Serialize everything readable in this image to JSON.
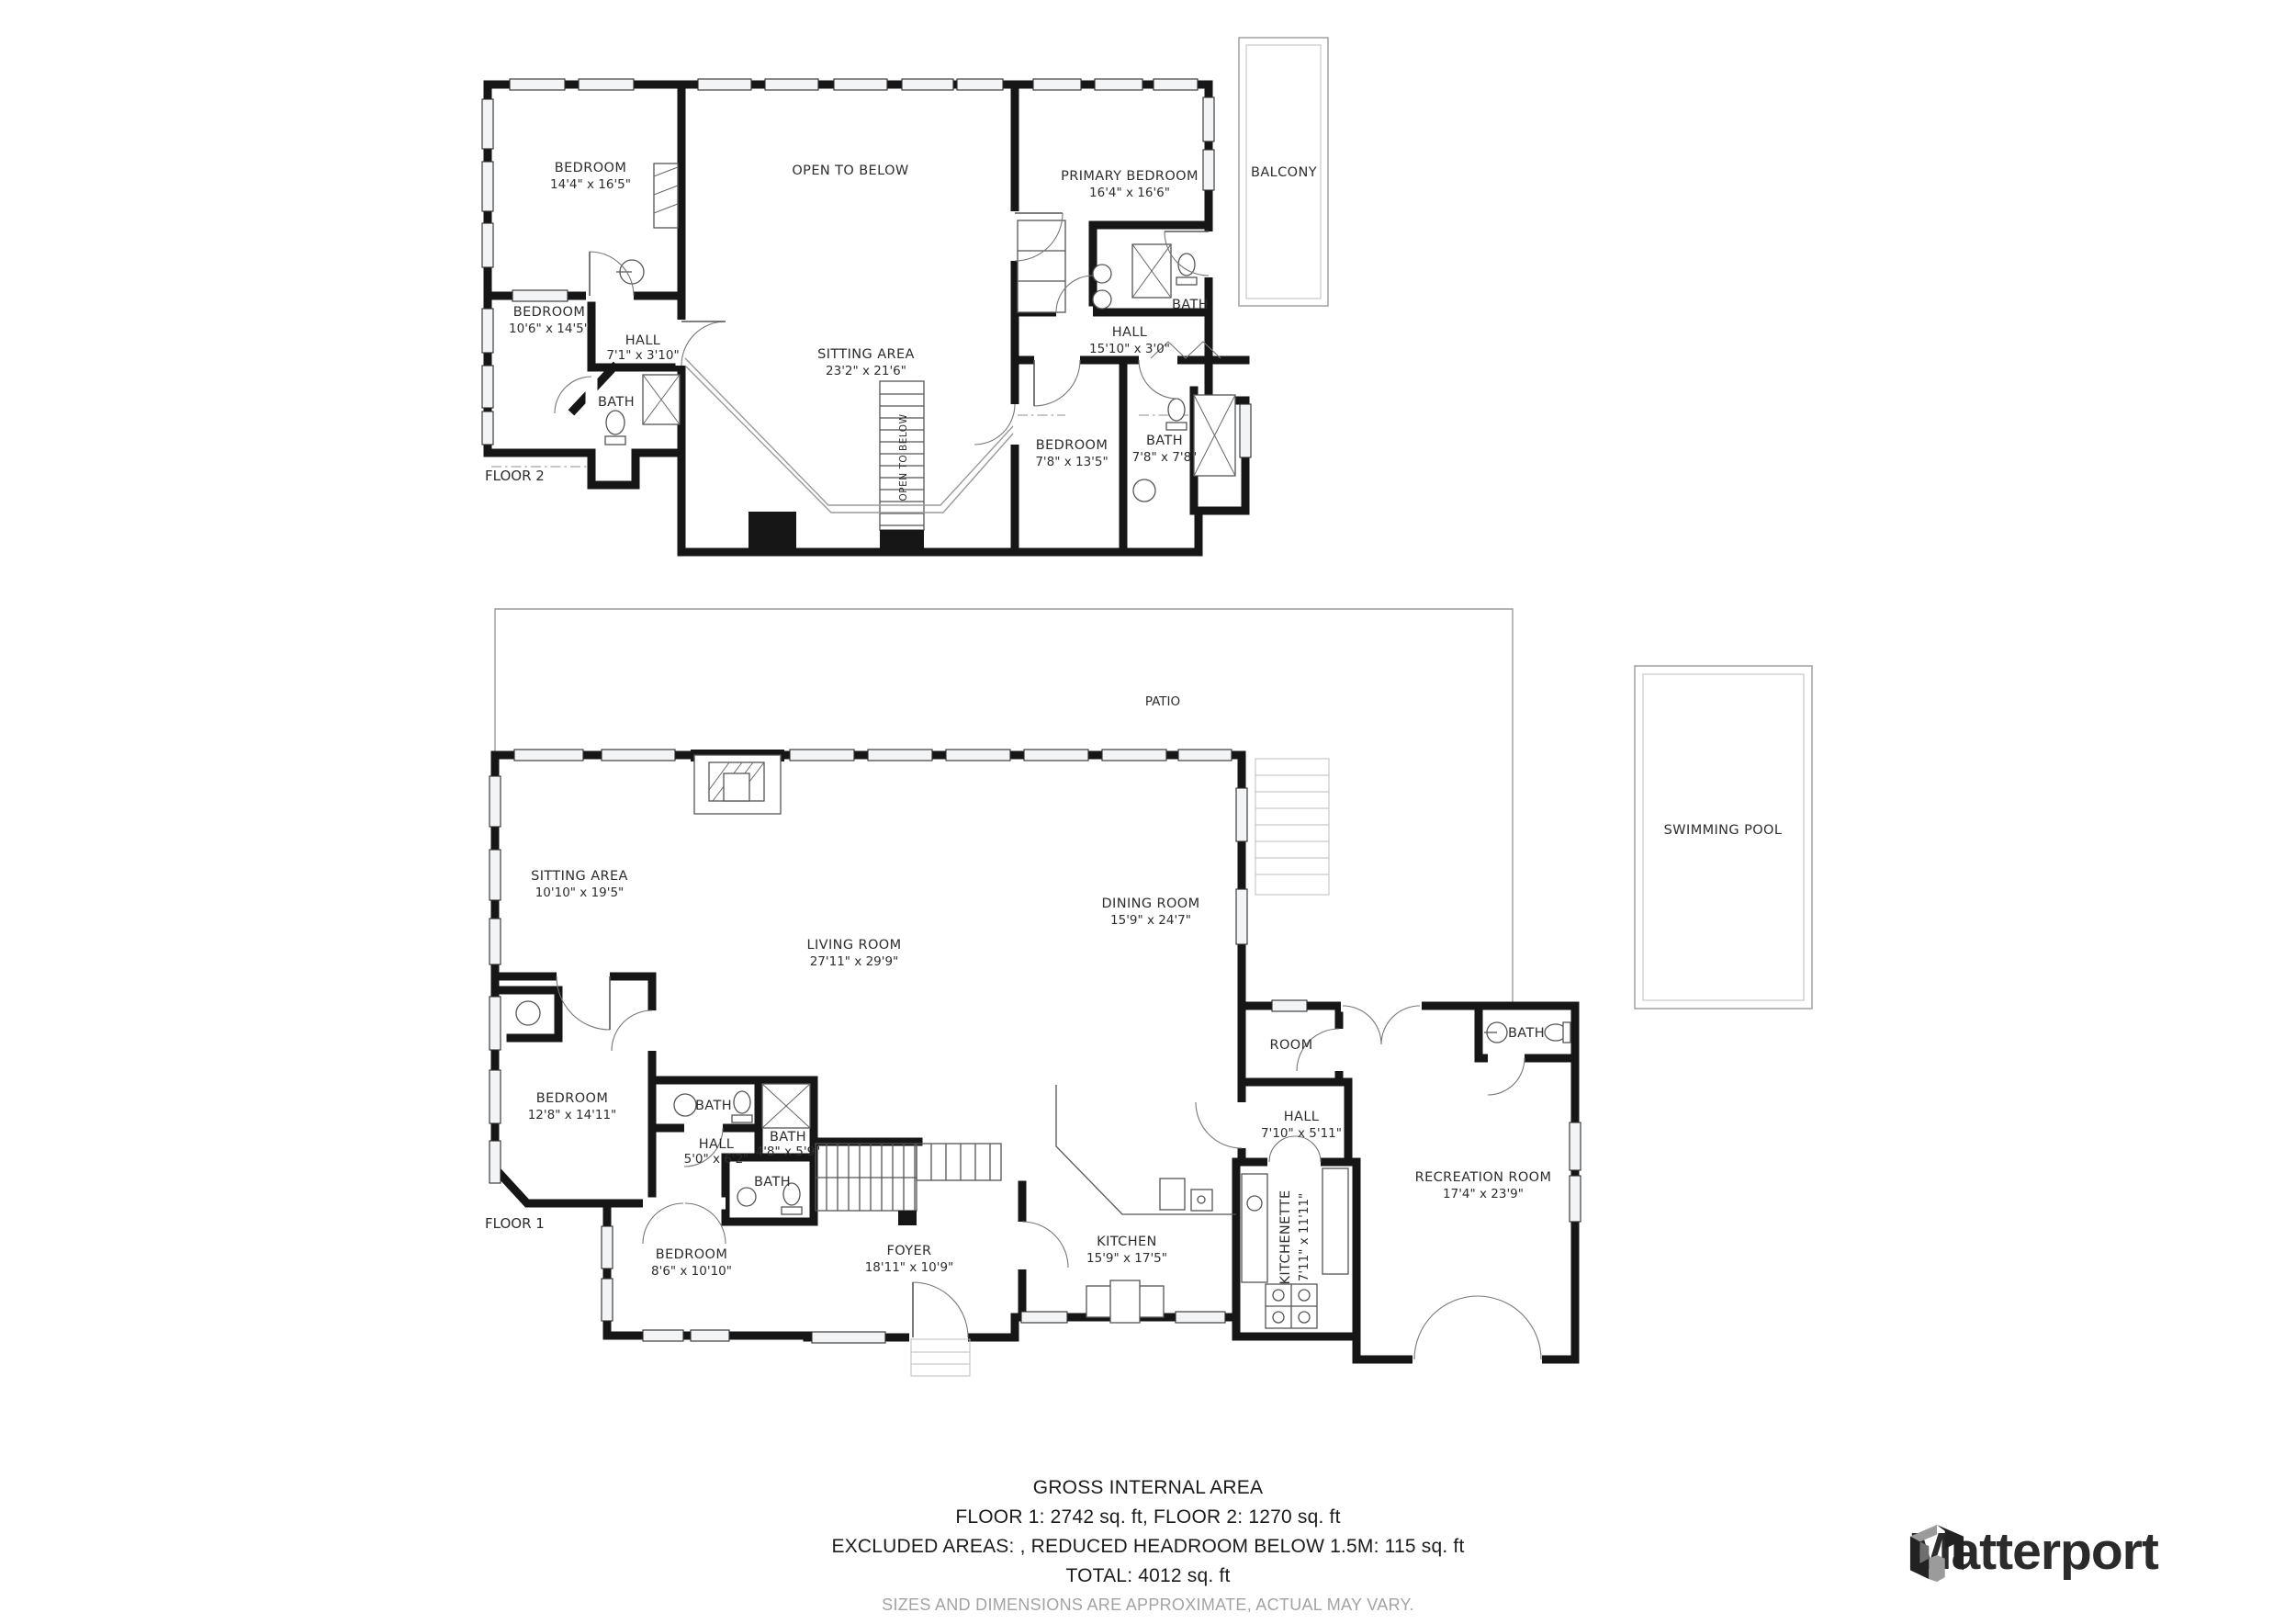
{
  "floor2": {
    "floor_label": "FLOOR 2",
    "rooms": {
      "bedroom1": {
        "name": "BEDROOM",
        "dims": "14'4\" x 16'5\""
      },
      "open_below": {
        "name": "OPEN TO BELOW"
      },
      "primary_bedroom": {
        "name": "PRIMARY BEDROOM",
        "dims": "16'4\" x 16'6\""
      },
      "balcony": {
        "name": "BALCONY"
      },
      "bedroom2": {
        "name": "BEDROOM",
        "dims": "10'6\" x 14'5\""
      },
      "hall": {
        "name": "HALL",
        "dims": "7'1\" x 3'10\""
      },
      "bath_left": {
        "name": "BATH"
      },
      "sitting_area": {
        "name": "SITTING AREA",
        "dims": "23'2\" x 21'6\""
      },
      "hall_right": {
        "name": "HALL",
        "dims": "15'10\" x 3'0\""
      },
      "bath_primary": {
        "name": "BATH"
      },
      "bedroom3": {
        "name": "BEDROOM",
        "dims": "7'8\" x 13'5\""
      },
      "bath_right": {
        "name": "BATH",
        "dims": "7'8\" x 7'8\""
      },
      "stairwell": {
        "name": "OPEN TO BELOW"
      }
    }
  },
  "floor1": {
    "floor_label": "FLOOR 1",
    "rooms": {
      "patio": {
        "name": "PATIO"
      },
      "sitting_area": {
        "name": "SITTING AREA",
        "dims": "10'10\" x 19'5\""
      },
      "living_room": {
        "name": "LIVING ROOM",
        "dims": "27'11\" x 29'9\""
      },
      "dining_room": {
        "name": "DINING ROOM",
        "dims": "15'9\" x 24'7\""
      },
      "room": {
        "name": "ROOM"
      },
      "bath_ne": {
        "name": "BATH"
      },
      "bedroom_w": {
        "name": "BEDROOM",
        "dims": "12'8\" x 14'11\""
      },
      "bath_a": {
        "name": "BATH"
      },
      "hall_w": {
        "name": "HALL",
        "dims": "5'0\" x 6'2\""
      },
      "bath_b": {
        "name": "BATH",
        "dims": "4'8\" x 5'9\""
      },
      "bath_c": {
        "name": "BATH"
      },
      "hall_e": {
        "name": "HALL",
        "dims": "7'10\" x 5'11\""
      },
      "recreation_room": {
        "name": "RECREATION ROOM",
        "dims": "17'4\" x 23'9\""
      },
      "bedroom_s": {
        "name": "BEDROOM",
        "dims": "8'6\" x 10'10\""
      },
      "foyer": {
        "name": "FOYER",
        "dims": "18'11\" x 10'9\""
      },
      "kitchen": {
        "name": "KITCHEN",
        "dims": "15'9\" x 17'5\""
      },
      "kitchenette": {
        "name": "KITCHENETTE",
        "dims": "7'11\" x 11'11\""
      },
      "swimming_pool": {
        "name": "SWIMMING POOL"
      }
    }
  },
  "footer": {
    "heading": "GROSS INTERNAL AREA",
    "area_line": "FLOOR 1: 2742 sq. ft, FLOOR 2: 1270 sq. ft",
    "excluded_line": "EXCLUDED AREAS: , REDUCED HEADROOM BELOW 1.5M: 115 sq. ft",
    "total_line": "TOTAL: 4012 sq. ft",
    "disclaimer": "SIZES AND DIMENSIONS ARE APPROXIMATE, ACTUAL MAY VARY."
  },
  "brand": {
    "name": "Matterport"
  },
  "colors": {
    "wall": "#161616",
    "patio_line": "#9a9a9a",
    "disclaimer": "#a3a3a3",
    "brand_text": "#2b2b2b"
  }
}
